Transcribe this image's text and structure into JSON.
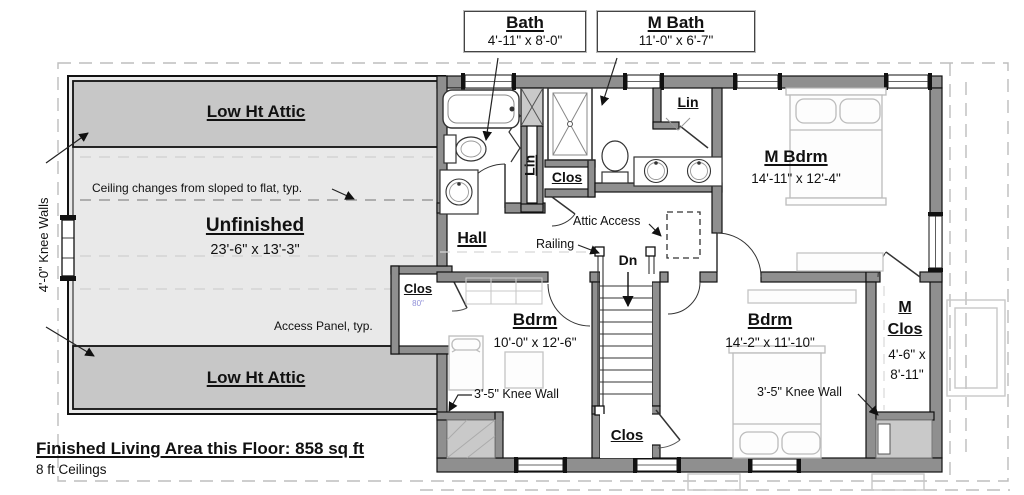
{
  "callouts": {
    "bath": {
      "title": "Bath",
      "dims": "4'-11\" x 8'-0\""
    },
    "mbath": {
      "title": "M Bath",
      "dims": "11'-0\" x 6'-7\""
    }
  },
  "attic": {
    "low_top": "Low Ht Attic",
    "low_bottom": "Low Ht Attic",
    "unfinished_title": "Unfinished",
    "unfinished_dims": "23'-6\" x 13'-3\"",
    "ceiling_note": "Ceiling changes from sloped to flat, typ.",
    "access_panel_note": "Access Panel, typ.",
    "knee_walls_label": "4'-0\" Knee Walls"
  },
  "hall": {
    "title": "Hall",
    "railing": "Railing",
    "dn": "Dn",
    "attic_access": "Attic Access"
  },
  "rooms": {
    "m_bdrm": {
      "title": "M Bdrm",
      "dims": "14'-11\" x 12'-4\""
    },
    "bdrm1": {
      "title": "Bdrm",
      "dims": "10'-0\" x 12'-6\""
    },
    "bdrm2": {
      "title": "Bdrm",
      "dims": "14'-2\" x 11'-10\""
    },
    "m_clos": {
      "line1": "M",
      "line2": "Clos",
      "dims1": "4'-6\" x",
      "dims2": "8'-11\""
    }
  },
  "closets": {
    "lin_bath": "Lin",
    "lin_mbath": "Lin",
    "clos_mid": "Clos",
    "clos_left": "Clos",
    "clos_left_dim": "80\"",
    "clos_stairs": "Clos"
  },
  "notes": {
    "knee_wall_left_room": "3'-5\" Knee Wall",
    "knee_wall_right_room": "3'-5\" Knee Wall"
  },
  "footer": {
    "area": "Finished Living Area this Floor: 858 sq ft",
    "ceilings": "8 ft Ceilings"
  },
  "colors": {
    "wall_fill": "#8f8f8f",
    "attic_band": "#c7c7c7",
    "unfinished_floor": "#e9e9e9",
    "shaded_area": "#c9c9c9",
    "dim_blue": "#8f8fd8",
    "line": "#111111",
    "furniture": "#bcbcbc",
    "roof_dash": "#bdbdbd"
  }
}
